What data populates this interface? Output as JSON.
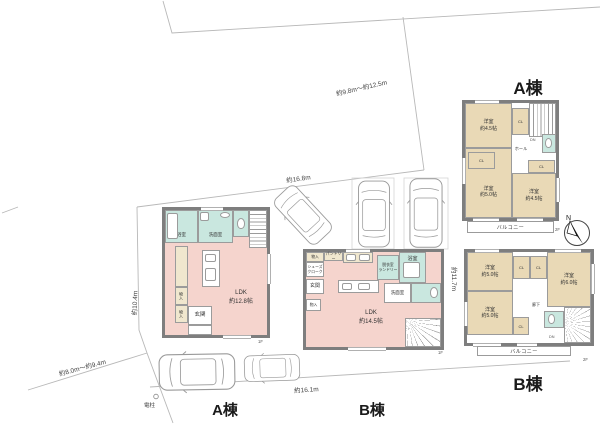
{
  "site": {
    "dim_top_range": "約9.8m～約12.5m",
    "dim_top": "約16.8m",
    "dim_left": "約10.4m",
    "dim_bottom_left": "約8.0m～約9.4m",
    "dim_bottom": "約16.1m",
    "dim_right": "約11.7m",
    "utility_pole": "電柱",
    "ground_label_a": "A棟",
    "ground_label_b": "B棟",
    "compass_north": "N"
  },
  "labels": {
    "cl": "CL",
    "dn": "DN",
    "f1": "1F",
    "f2": "2F",
    "hall": "ホール",
    "corridor": "廊下",
    "balcony": "バルコニー",
    "bath": "浴室",
    "washroom": "洗面室",
    "entrance": "玄関",
    "storage": "物入",
    "western": "洋室",
    "ldk": "LDK"
  },
  "building_a": {
    "title": "A棟",
    "f1": {
      "ldk_size": "約12.8帖"
    },
    "f2": {
      "room_tl_size": "約4.5帖",
      "room_bl_size": "約5.0帖",
      "room_br_size": "約4.5帖"
    }
  },
  "building_b": {
    "title": "B棟",
    "f1": {
      "ldk_size": "約14.5帖",
      "shoes_line1": "シューズ",
      "shoes_line2": "クローク",
      "pantry": "パントリー",
      "laundry_line1": "脱衣室",
      "laundry_line2": "ランドリー"
    },
    "f2": {
      "room_tl_size": "約5.0帖",
      "room_r_size": "約6.0帖",
      "room_bl_size": "約5.0帖"
    }
  }
}
